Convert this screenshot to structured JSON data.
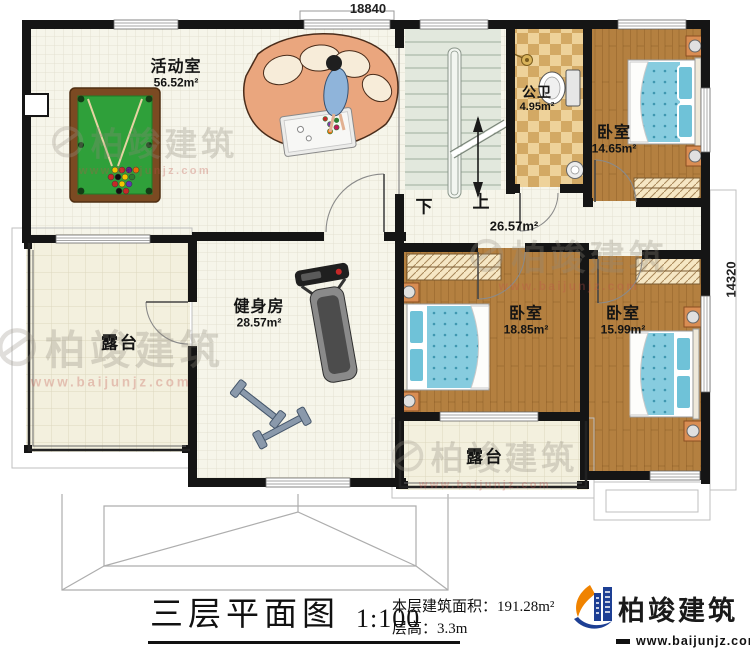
{
  "dimensions": {
    "top": "18840",
    "right": "14320"
  },
  "rooms": {
    "activity": {
      "name": "活动室",
      "area": "56.52m²"
    },
    "bathroom": {
      "name": "公卫",
      "area": "4.95m²"
    },
    "bedroom_top": {
      "name": "卧室",
      "area": "14.65m²"
    },
    "hall": {
      "area": "26.57m²"
    },
    "gym": {
      "name": "健身房",
      "area": "28.57m²"
    },
    "terrace_left": {
      "name": "露台"
    },
    "bedroom_mid": {
      "name": "卧室",
      "area": "18.85m²"
    },
    "bedroom_right": {
      "name": "卧室",
      "area": "15.99m²"
    },
    "terrace_bottom": {
      "name": "露台"
    },
    "stairs": {
      "down": "下",
      "up": "上"
    }
  },
  "title_block": {
    "title": "三层平面图",
    "scale": "1:100",
    "area_label": "本层建筑面积：",
    "area_value": "191.28m²",
    "floor_height": "层高：3.3m"
  },
  "logo": {
    "name": "柏竣建筑",
    "url": "www.baijunjz.com"
  },
  "watermark": {
    "text": "柏竣建筑",
    "url": "www.baijunjz.com"
  },
  "colors": {
    "wall": "#151515",
    "wood_floor": "#b48040",
    "bed_blue": "#87ccdf",
    "pool_felt": "#2fa03a",
    "logo_orange": "#f08300",
    "logo_blue": "#1d3f94",
    "watermark_red": "#c0524a"
  }
}
